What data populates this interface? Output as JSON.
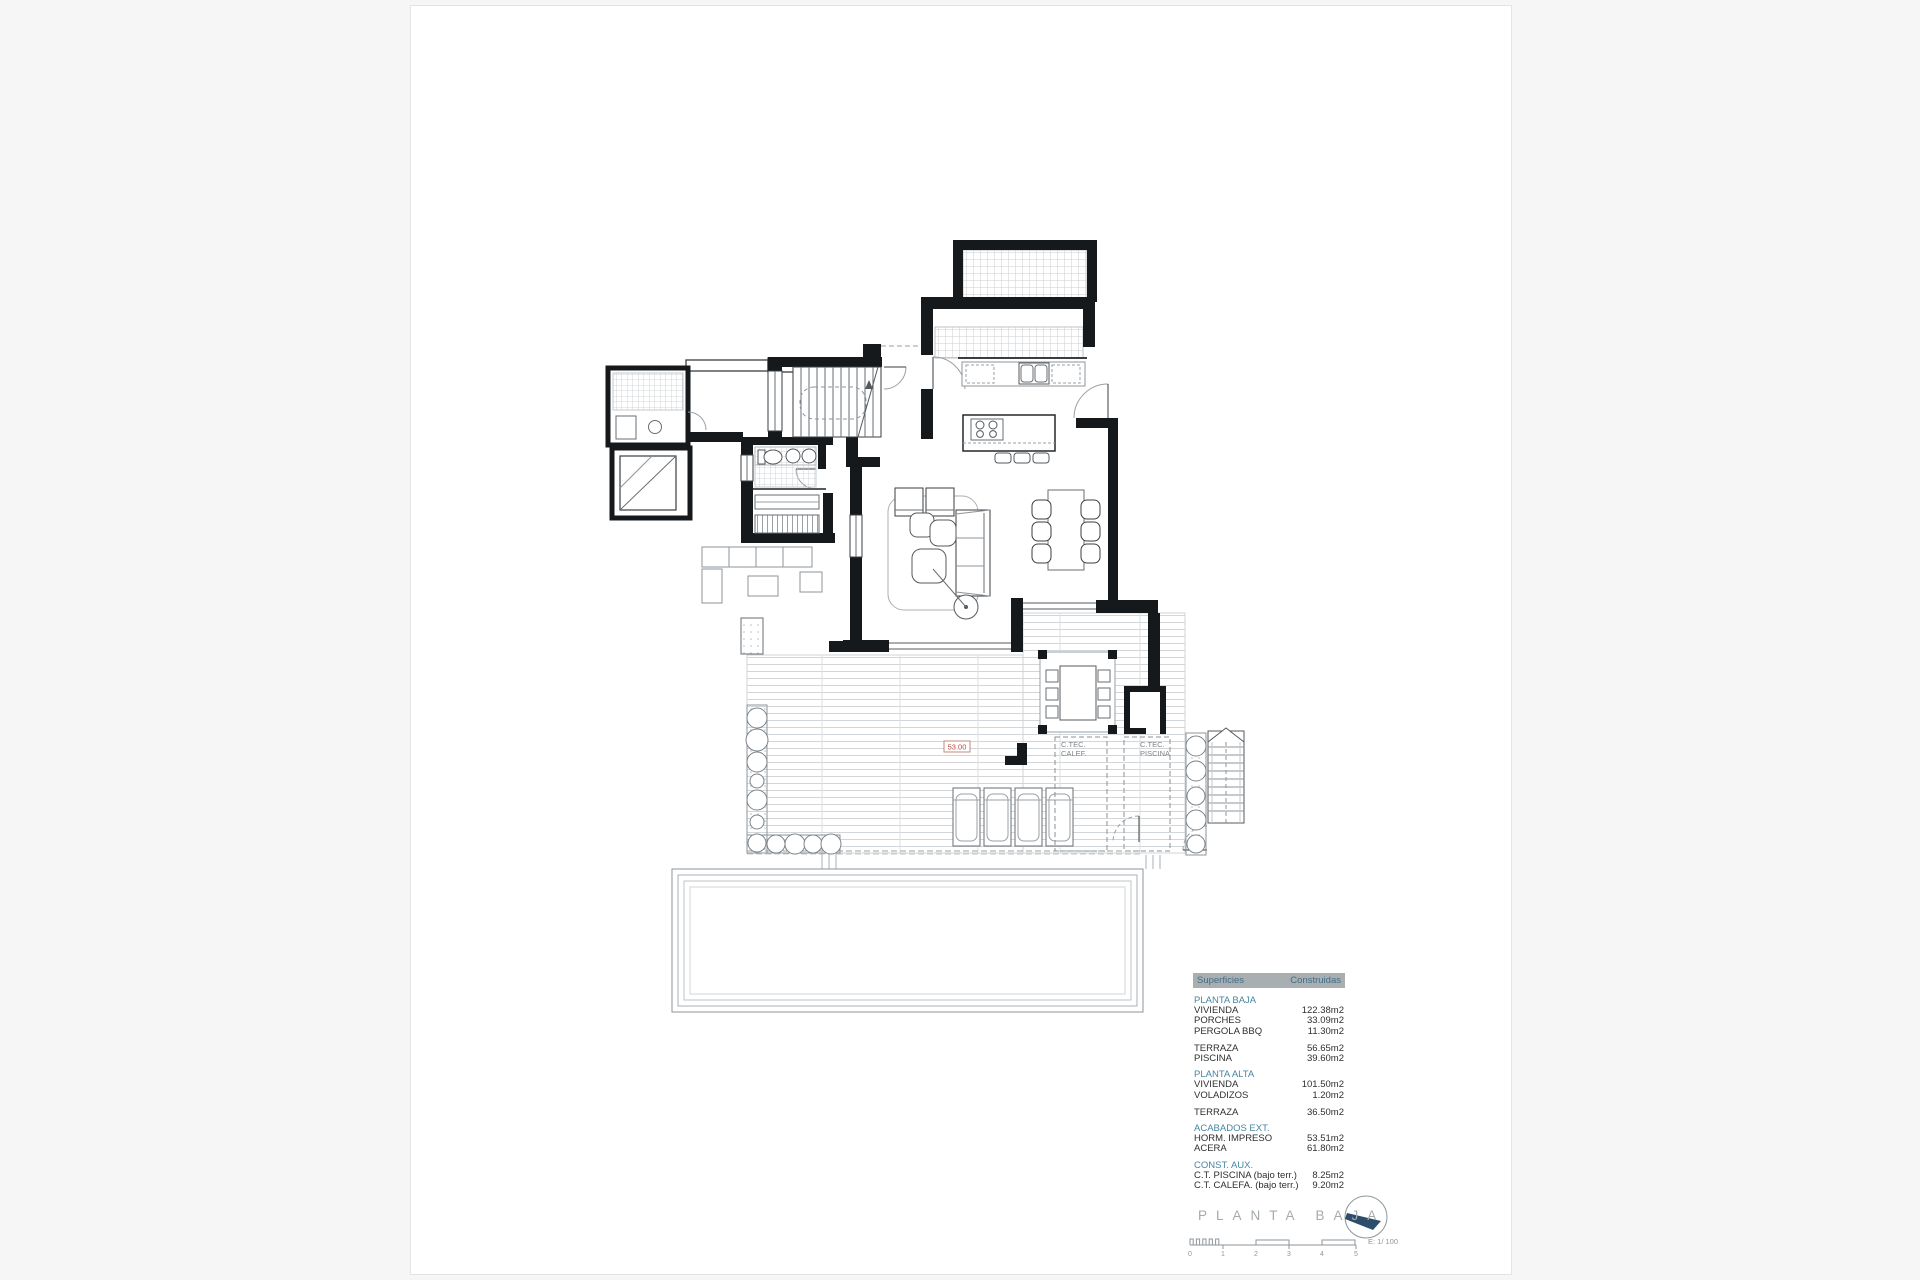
{
  "sheet": {
    "title": "PLANTA BAJA",
    "scale_text": "E: 1/ 100",
    "scale_ticks": [
      "0",
      "1",
      "2",
      "3",
      "4",
      "5"
    ]
  },
  "areas_table": {
    "header": {
      "col1": "Superficies",
      "col2": "Construidas"
    },
    "rows": [
      {
        "label": "PLANTA BAJA",
        "value": ""
      },
      {
        "label": "VIVIENDA",
        "value": "122.38m2"
      },
      {
        "label": "PORCHES",
        "value": "33.09m2"
      },
      {
        "label": "PERGOLA BBQ",
        "value": "11.30m2"
      },
      {
        "label": "TERRAZA",
        "value": "56.65m2"
      },
      {
        "label": "PISCINA",
        "value": "39.60m2"
      },
      {
        "label": "PLANTA ALTA",
        "value": ""
      },
      {
        "label": "VIVIENDA",
        "value": "101.50m2"
      },
      {
        "label": "VOLADIZOS",
        "value": "1.20m2"
      },
      {
        "label": "TERRAZA",
        "value": "36.50m2"
      },
      {
        "label": "ACABADOS EXT.",
        "value": ""
      },
      {
        "label": "HORM. IMPRESO",
        "value": "53.51m2"
      },
      {
        "label": "ACERA",
        "value": "61.80m2"
      },
      {
        "label": "CONST. AUX.",
        "value": ""
      },
      {
        "label": "C.T. PISCINA (bajo terr.)",
        "value": "8.25m2"
      },
      {
        "label": "C.T. CALEFA. (bajo terr.)",
        "value": "9.20m2"
      }
    ]
  },
  "plan_labels": {
    "ctec_calef_1": "C.TEC.",
    "ctec_calef_2": "CALEF.",
    "ctec_piscina_1": "C.TEC.",
    "ctec_piscina_2": "PISCINA",
    "level_mark": "53.00"
  },
  "colors": {
    "wall": "#16191c",
    "accent_teal": "#4786a0",
    "red_mark": "#b5483b",
    "title_gray": "#a3abae"
  }
}
